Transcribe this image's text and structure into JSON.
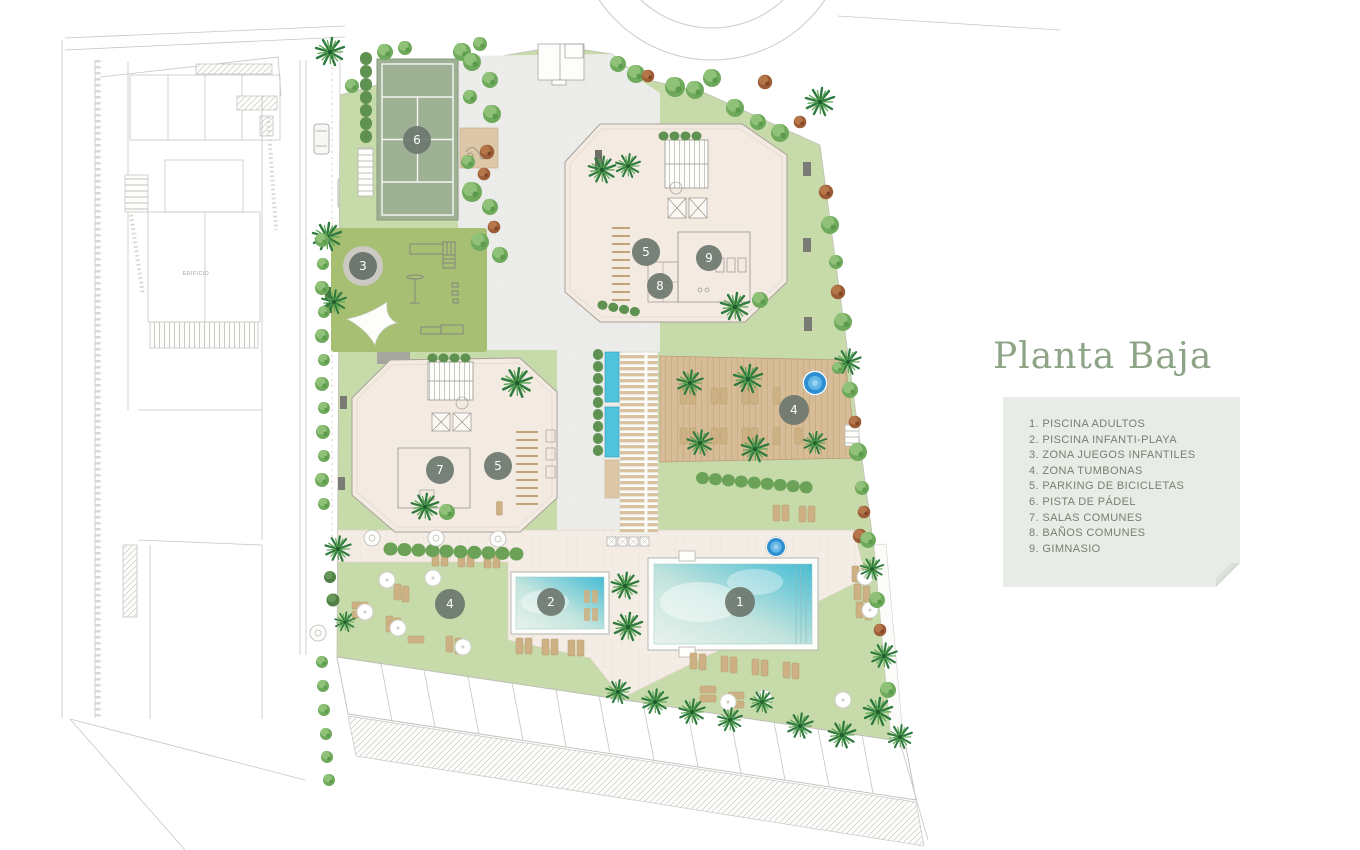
{
  "title": "Planta Baja",
  "legend": {
    "items": [
      "1. PISCINA ADULTOS",
      "2. PISCINA INFANTI-PLAYA",
      "3. ZONA JUEGOS INFANTILES",
      "4. ZONA TUMBONAS",
      "5. PARKING DE BICICLETAS",
      "6. PISTA DE PÁDEL",
      "7. SALAS COMUNES",
      "8. BAÑOS COMUNES",
      "9. GIMNASIO"
    ]
  },
  "markers": [
    "6",
    "3",
    "5",
    "8",
    "9",
    "7",
    "5",
    "4",
    "4",
    "2",
    "1"
  ],
  "plan": {
    "neighbor_label": "EDIFICIO"
  },
  "colors": {
    "title_text": "#8da487",
    "legend_bg": "#e8ece7",
    "legend_text": "#75806f",
    "marker_bg": "#6d776f",
    "lawn": "#c7dbaa",
    "playground_green": "#a7bf72",
    "padel_green": "#9eb195",
    "deck_wood": "#d7bd97",
    "terrace_tile": "#f4ede5",
    "plaza_tile": "#ececea",
    "pool_water": "#45bcd4",
    "spa_water": "#2e8fd0"
  }
}
